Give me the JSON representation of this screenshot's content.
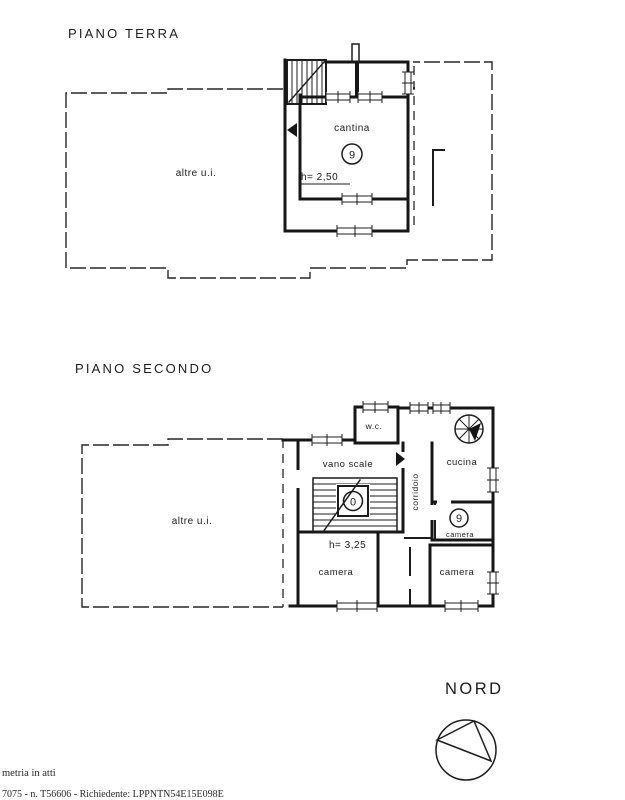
{
  "page": {
    "background": "#ffffff",
    "ink": "#1c1c1c"
  },
  "ground_floor": {
    "title": "PIANO TERRA",
    "other_unit_label": "altre u.i.",
    "room_label": "cantina",
    "room_number": "9",
    "height_note": "h= 2,50"
  },
  "second_floor": {
    "title": "PIANO SECONDO",
    "other_unit_label": "altre u.i.",
    "wc_label": "w.c.",
    "stairwell_label": "vano scale",
    "stairwell_number": "0",
    "corridor_label": "corridoio",
    "kitchen_label": "cucina",
    "room9_number": "9",
    "room9_label": "camera",
    "bedroom_left_label": "camera",
    "bedroom_right_label": "camera",
    "height_note": "h= 3,25"
  },
  "compass": {
    "label": "NORD"
  },
  "footer": {
    "line1": "metria in atti",
    "line2": "7075 - n. T56606 - Richiedente: LPPNTN54E15E098E"
  }
}
